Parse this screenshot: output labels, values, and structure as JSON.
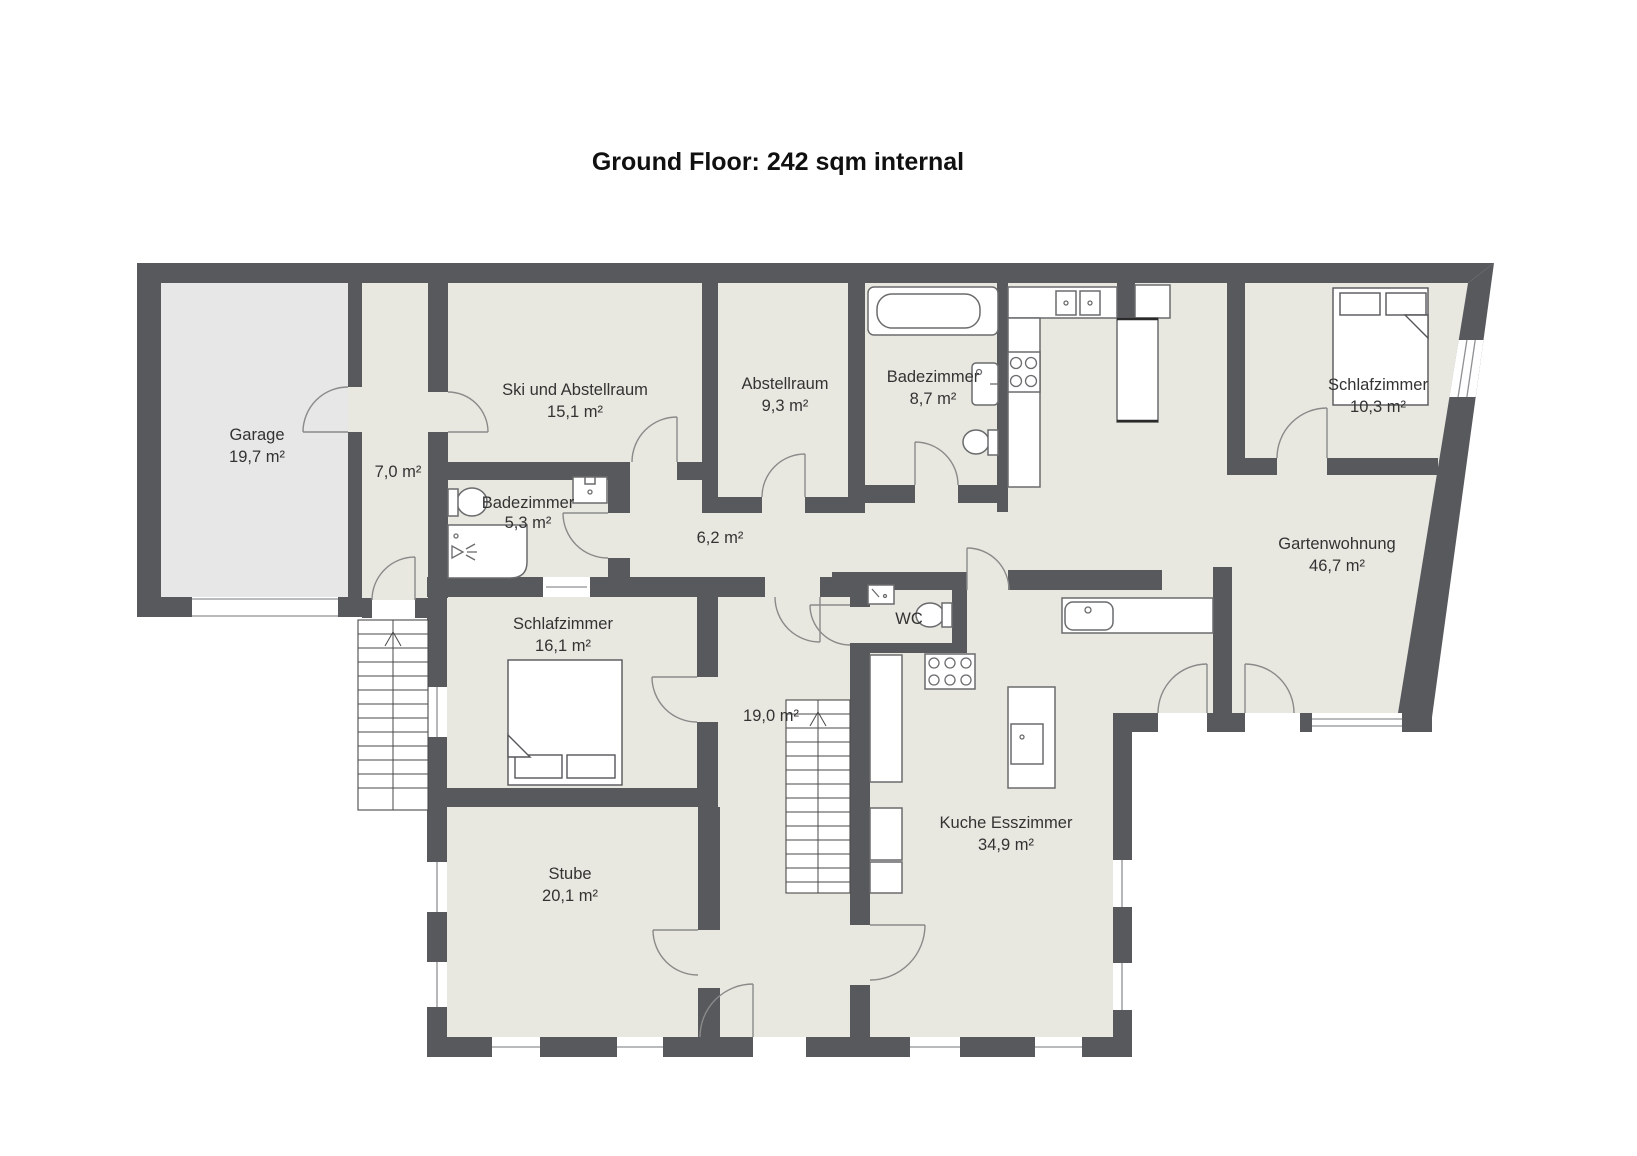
{
  "title": "Ground Floor: 242 sqm internal",
  "rooms": [
    {
      "name": "Garage",
      "area": "19,7 m²"
    },
    {
      "name": "",
      "area": "7,0 m²"
    },
    {
      "name": "Ski und Abstellraum",
      "area": "15,1 m²"
    },
    {
      "name": "Abstellraum",
      "area": "9,3 m²"
    },
    {
      "name": "Badezimmer",
      "area": "8,7 m²"
    },
    {
      "name": "Schlafzimmer",
      "area": "10,3 m²"
    },
    {
      "name": "Badezimmer",
      "area": "5,3 m²"
    },
    {
      "name": "",
      "area": "6,2 m²"
    },
    {
      "name": "Gartenwohnung",
      "area": "46,7 m²"
    },
    {
      "name": "Schlafzimmer",
      "area": "16,1 m²"
    },
    {
      "name": "WC",
      "area": ""
    },
    {
      "name": "",
      "area": "19,0 m²"
    },
    {
      "name": "Stube",
      "area": "20,1 m²"
    },
    {
      "name": "Kuche Esszimmer",
      "area": "34,9 m²"
    }
  ],
  "icon_names": [
    "bathtub-icon",
    "toilet-icon",
    "sink-icon",
    "shower-icon",
    "stove-icon",
    "kitchen-counter",
    "kitchen-island",
    "refrigerator-icon",
    "bed-icon",
    "stairs-icon",
    "door-swing-icon",
    "window-icon",
    "garage-door-icon"
  ],
  "colors": {
    "wall": "#58595d",
    "floor": "#e9e8e0",
    "garage_floor": "#e7e7e7",
    "line": "#8a8a8a",
    "text": "#333333"
  }
}
